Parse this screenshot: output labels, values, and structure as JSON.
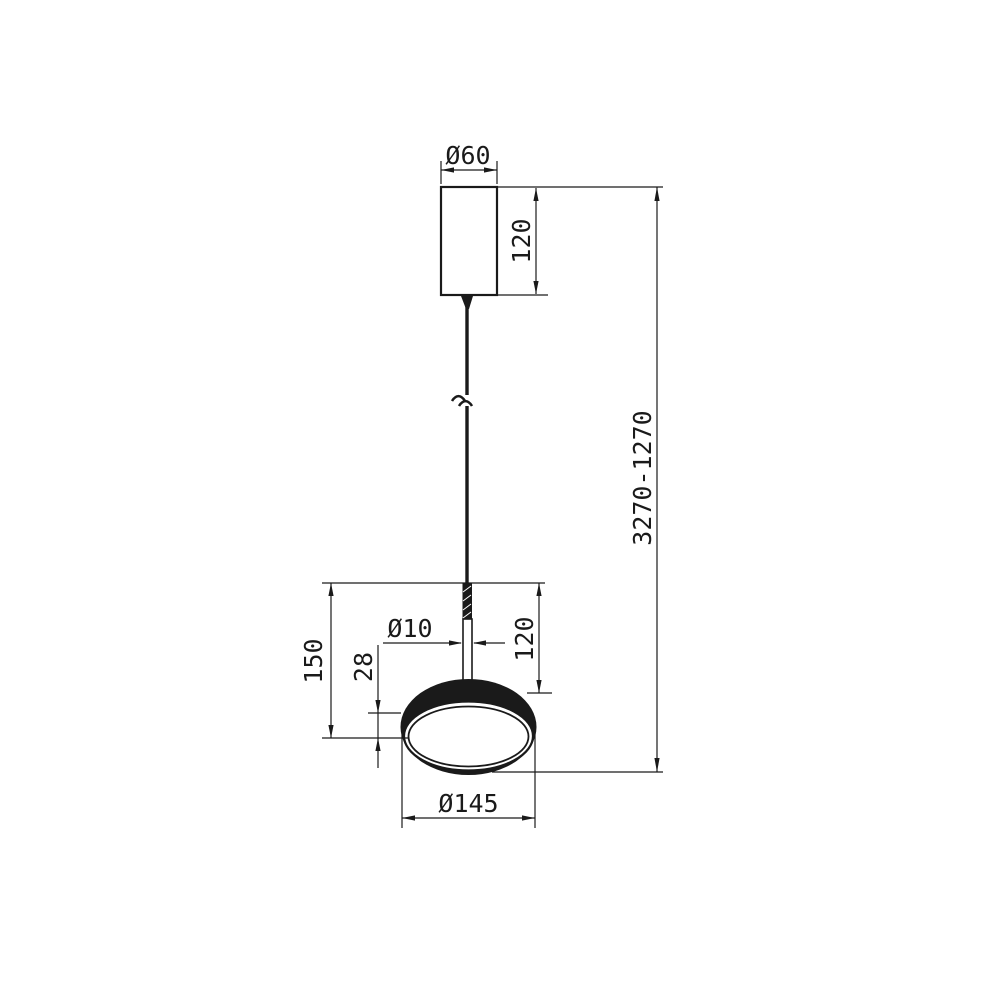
{
  "drawing": {
    "type": "technical-dimension-drawing",
    "subject": "pendant-lamp",
    "background_color": "#ffffff",
    "line_color": "#1a1a1a",
    "dimensions": {
      "canopy_diameter": "Ø60",
      "canopy_height": "120",
      "suspension_height_range": "3270-1270",
      "cable_diameter": "Ø10",
      "head_total_height": "150",
      "rim_thickness": "28",
      "stem_height": "120",
      "shade_diameter": "Ø145"
    }
  }
}
